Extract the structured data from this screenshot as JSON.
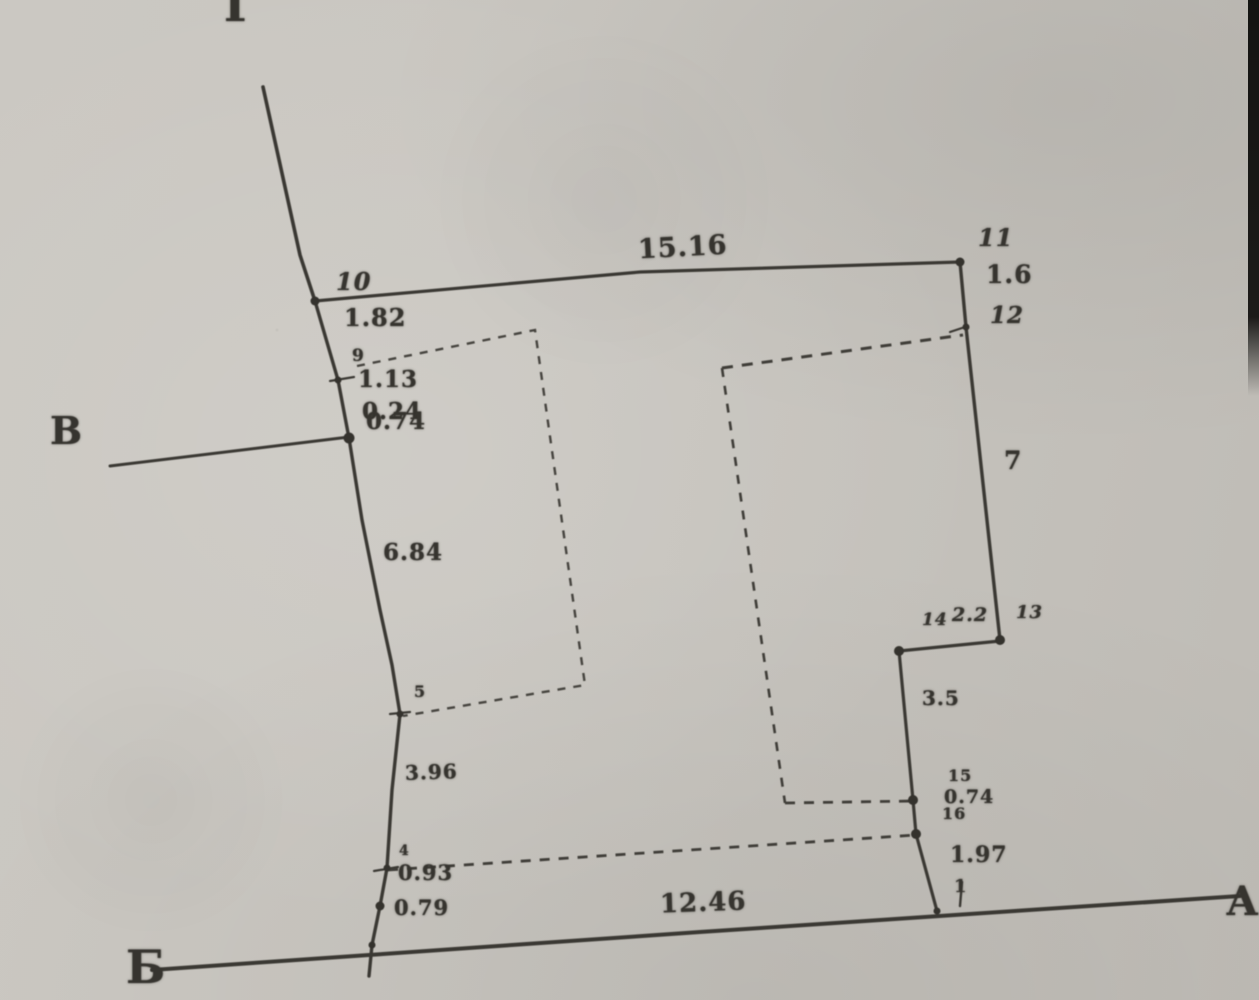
{
  "sketch": {
    "corner_letters": {
      "top": "Г",
      "left": "В",
      "bottom_left": "Б",
      "right": "А"
    },
    "points": {
      "p1": "1",
      "p4": "4",
      "p5": "5",
      "p9": "9",
      "p10": "10",
      "p11": "11",
      "p12": "12",
      "p13": "13",
      "p14": "14",
      "p15": "15",
      "p16": "16"
    },
    "distances": {
      "d_10_11": "15.16",
      "d_11_12": "1.6",
      "d_10_9": "1.82",
      "d_9_8": "1.13",
      "d_8_a": "0.24",
      "d_8_b": "0.74",
      "d_12_13": "7",
      "d_9_5": "6.84",
      "d_5_4": "3.96",
      "d_4_3": "0.93",
      "d_3_2": "0.79",
      "d_14_13": "2.2",
      "d_14_15": "3.5",
      "d_15_16": "0.74",
      "d_16_1": "1.97",
      "d_baseline": "12.46"
    },
    "colors": {
      "paper": "#c8c5bf",
      "ink": "#36342f"
    }
  }
}
